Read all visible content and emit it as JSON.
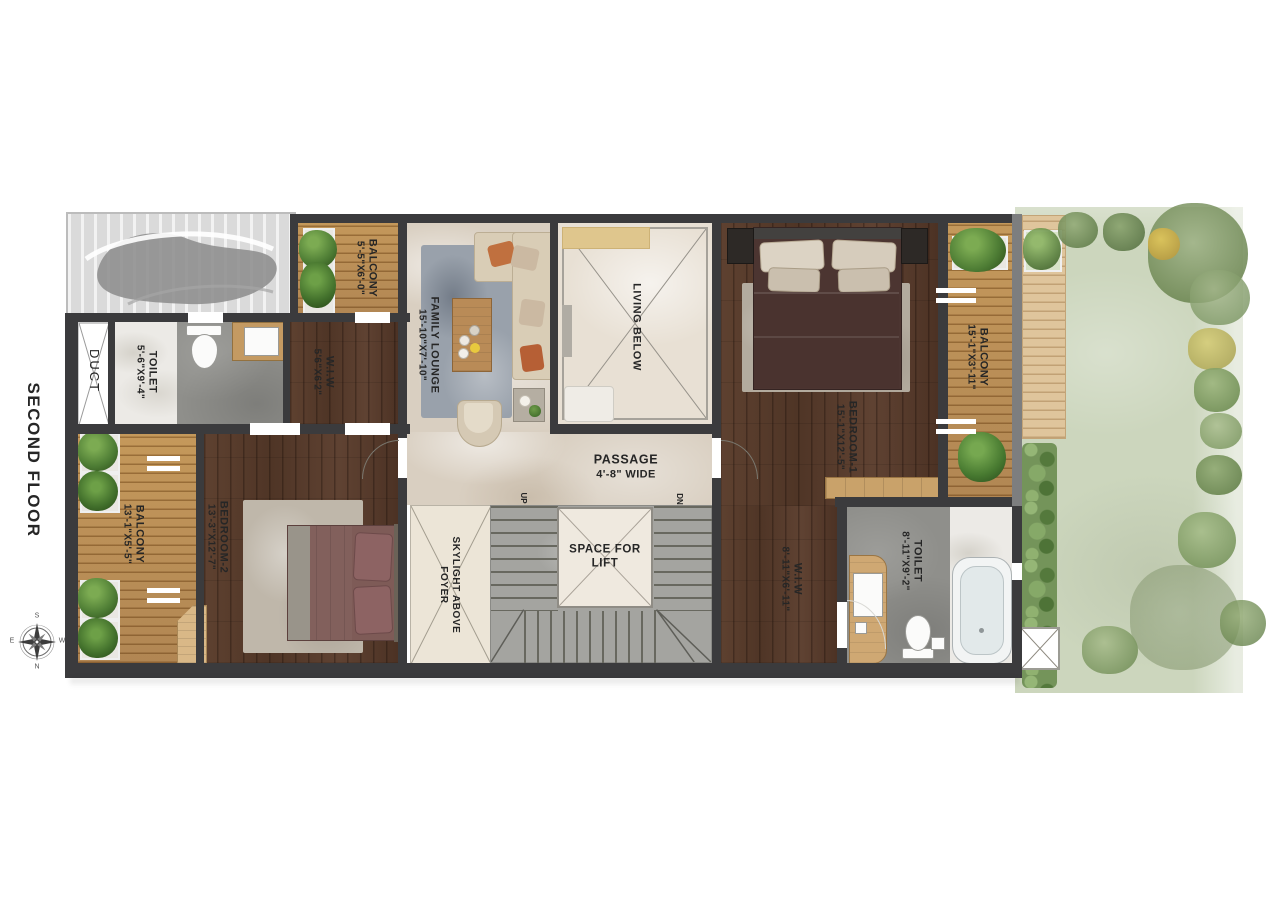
{
  "title": "SECOND FLOOR",
  "compass": {
    "north": "N",
    "south": "S",
    "east": "E",
    "west": "W"
  },
  "rooms": {
    "duct": {
      "name": "DUCT"
    },
    "toilet_2": {
      "name": "TOILET",
      "dim": "5'-6\"X9'-4\""
    },
    "balcony_top": {
      "name": "BALCONY",
      "dim": "5'-5\"X6'-0\""
    },
    "wiw_2": {
      "name": "W.I.W",
      "dim": "5'6\"X6'2\""
    },
    "family_lounge": {
      "name": "FAMILY LOUNGE",
      "dim": "15'-10\"X7'-10\""
    },
    "living_below": {
      "name": "LIVING BELOW"
    },
    "bedroom_1": {
      "name": "BEDROOM-1",
      "dim": "15'-1\"X12'-5\""
    },
    "balcony_right": {
      "name": "BALCONY",
      "dim": "15'-1\"X3'-11\""
    },
    "passage": {
      "name": "PASSAGE",
      "dim": "4'-8\" WIDE"
    },
    "lift": {
      "line1": "SPACE FOR",
      "line2": "LIFT"
    },
    "skylight_foyer": {
      "line1": "SKYLIGHT ABOVE",
      "line2": "FOYER"
    },
    "bedroom_2": {
      "name": "BEDROOM-2",
      "dim": "13'-3\"X12'-7\""
    },
    "balcony_left": {
      "name": "BALCONY",
      "dim": "13'-1\"X5'-5\""
    },
    "wiw_1": {
      "name": "W.I.W",
      "dim": "8'-11\"X6'-11\""
    },
    "toilet_1": {
      "name": "TOILET",
      "dim": "8'-11\"X9'-2\""
    }
  },
  "stairs": {
    "up": "UP",
    "down": "DN"
  },
  "colors": {
    "wall": "#3b3b3d",
    "wood_floor": "#56392a",
    "deck_wood": "#b8894f",
    "marble_floor": "#d9cfc1",
    "bathroom_floor": "#8f8f8b",
    "stair_floor": "#a4a4a0",
    "grass": "#ccd6bd",
    "foliage": "#4d7c34",
    "label_text": "#262626"
  }
}
